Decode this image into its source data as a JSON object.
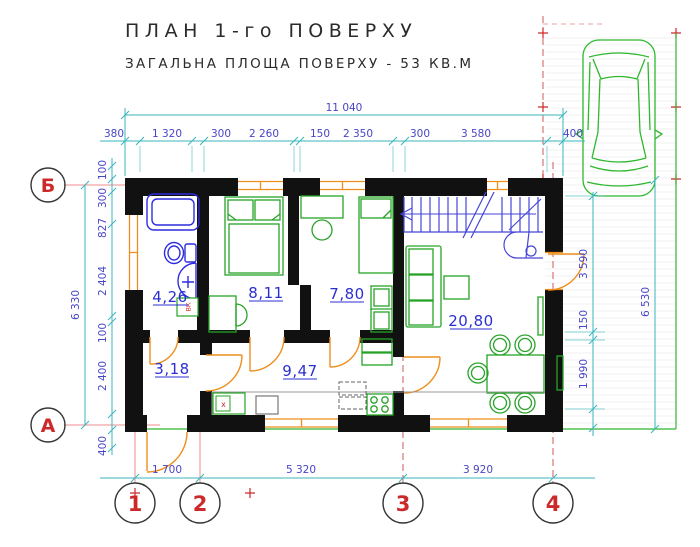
{
  "title": "ПЛАН 1-го ПОВЕРХУ",
  "subtitle": "ЗАГАЛЬНА ПЛОЩА ПОВЕРХУ  - 53 КВ.М",
  "colors": {
    "dimension_line": "#3ab5bd",
    "dimension_text": "#4745c8",
    "room_label": "#2b2fd0",
    "wall": "#111111",
    "furniture_green": "#27a327",
    "plumbing_blue": "#2d2de0",
    "stairs_blue": "#4646d8",
    "door_orange": "#ef8e1c",
    "axis_red": "#cc2a2a"
  },
  "axes": {
    "rows": [
      {
        "label": "Б"
      },
      {
        "label": "А"
      }
    ],
    "cols": [
      {
        "label": "1"
      },
      {
        "label": "2"
      },
      {
        "label": "3"
      },
      {
        "label": "4"
      }
    ]
  },
  "dimensions": {
    "top_total": "11 040",
    "top_chain": [
      "380",
      "1 320",
      "300",
      "2 260",
      "150",
      "2 350",
      "300",
      "3 580",
      "400"
    ],
    "left_total": "6 330",
    "left_chain": [
      "100",
      "300",
      "827",
      "2 404",
      "100",
      "2 400",
      "400"
    ],
    "right_chain": [
      "3 590",
      "150",
      "1 990"
    ],
    "right_total": "6 530",
    "bottom_chain": [
      "1 700",
      "5 320",
      "3 920"
    ]
  },
  "rooms": [
    {
      "name": "bathroom",
      "area": "4,26"
    },
    {
      "name": "bedroom-1",
      "area": "8,11"
    },
    {
      "name": "bedroom-2",
      "area": "7,80"
    },
    {
      "name": "living-room",
      "area": "20,80"
    },
    {
      "name": "hallway",
      "area": "3,18"
    },
    {
      "name": "kitchen",
      "area": "9,47"
    }
  ],
  "annotations": {
    "duct_label": "ВК",
    "sink_mark": "x"
  }
}
